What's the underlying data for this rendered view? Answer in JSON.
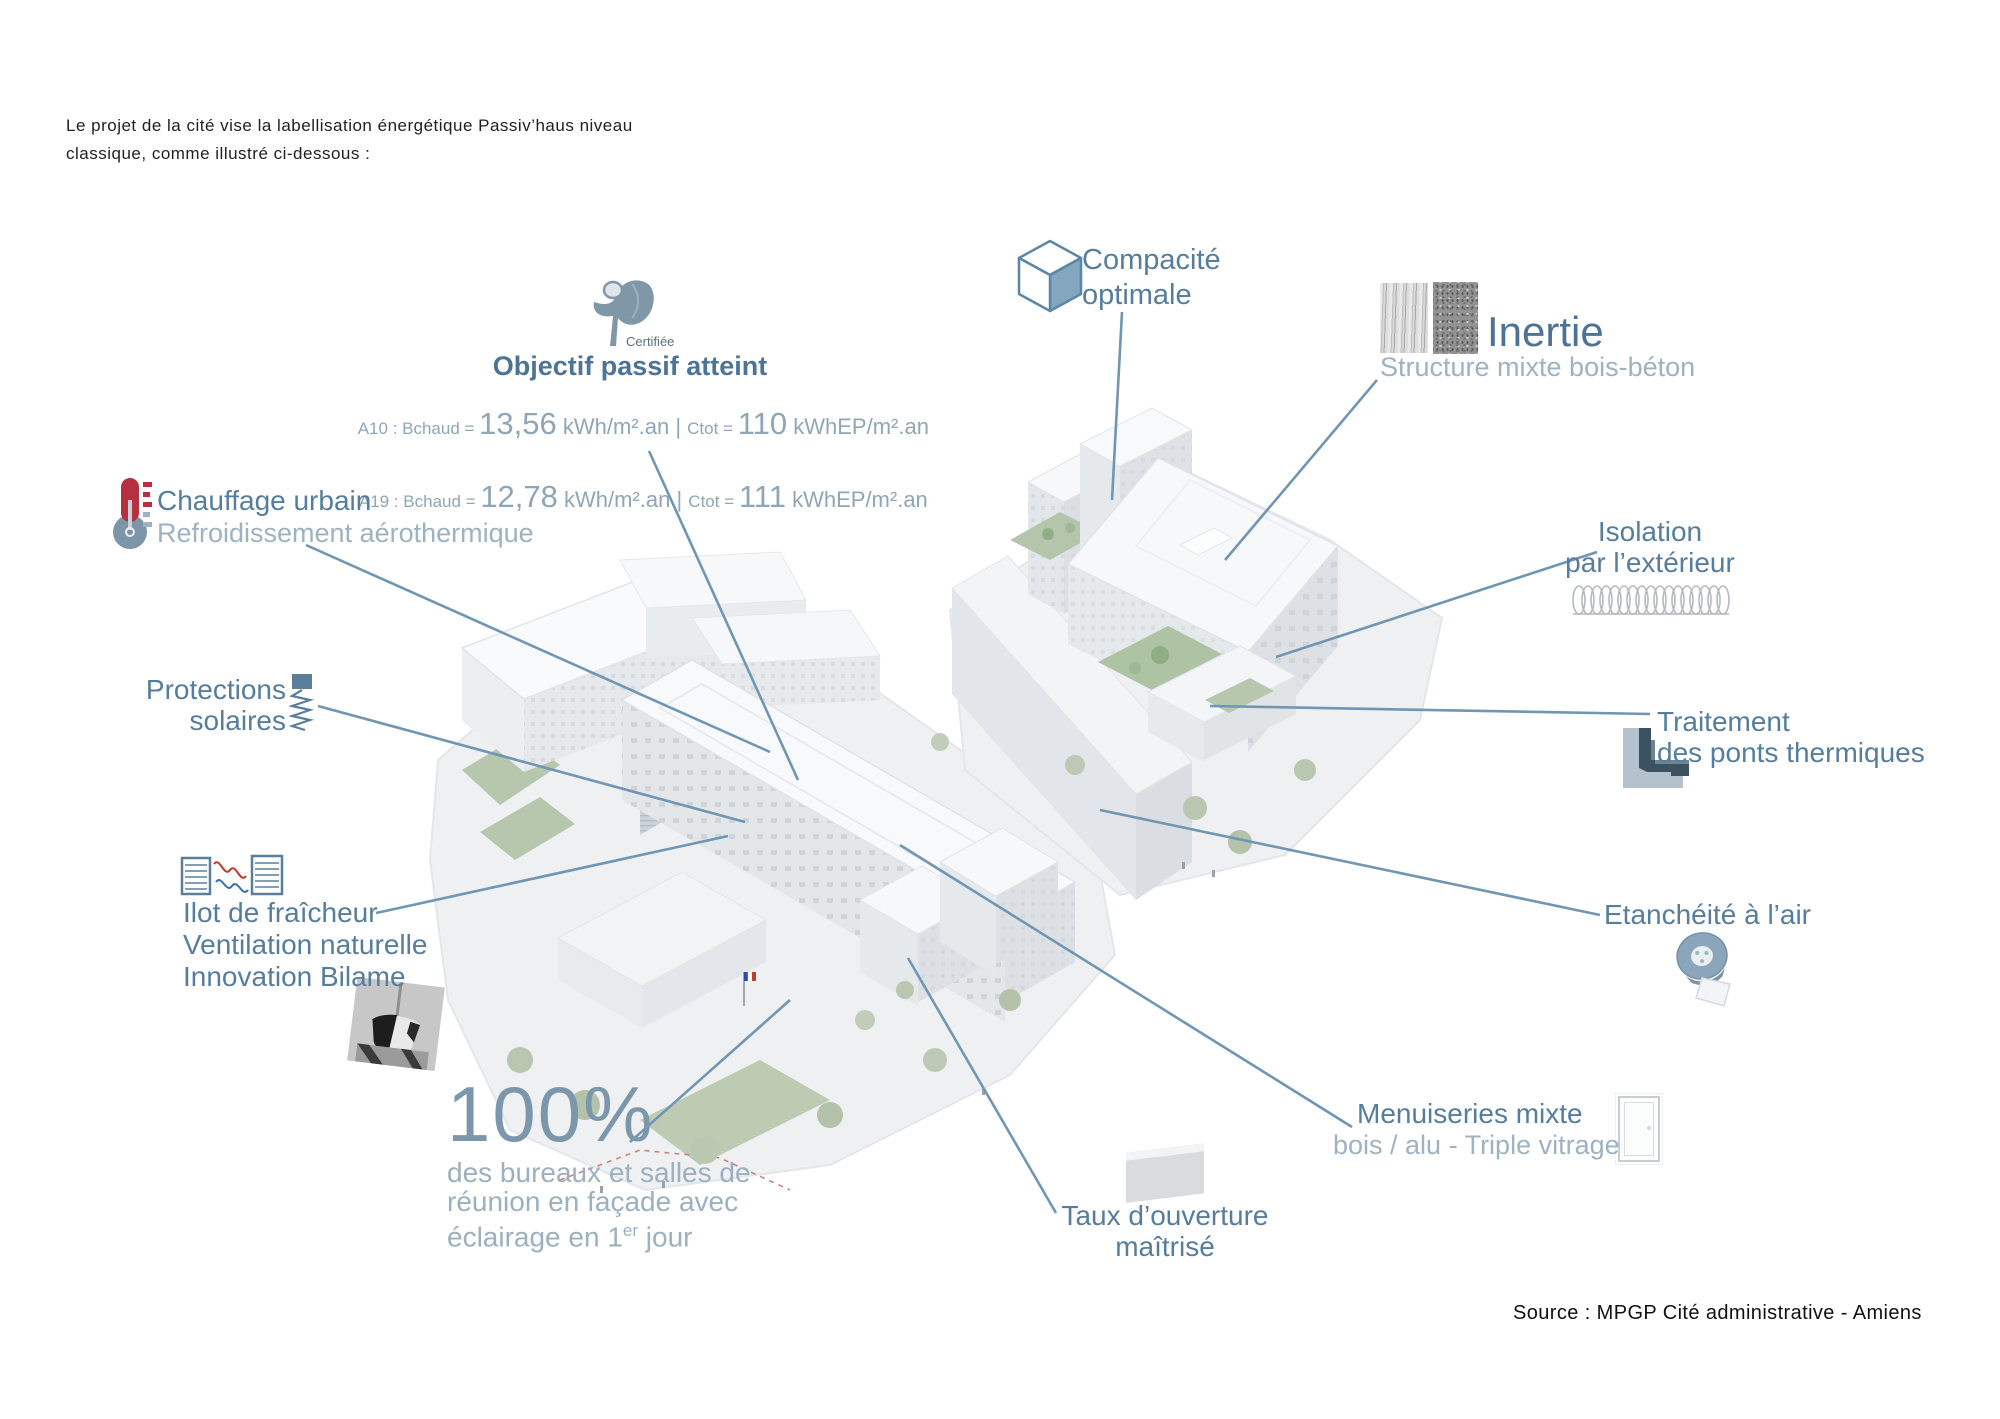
{
  "page": {
    "intro": "Le projet de la cité vise la labellisation énergétique Passiv’haus niveau classique, comme illustré ci-dessous :",
    "source": "Source : MPGP Cité administrative - Amiens"
  },
  "colors": {
    "leader_line": "#7096b3",
    "heading": "#567d9c",
    "subtle": "#9fb2c1",
    "thermometer_red": "#b6303e",
    "cube_face": "#82a7bf"
  },
  "callouts": {
    "objectif": {
      "certified_label": "Certifiée",
      "title": "Objectif passif atteint",
      "stats": [
        {
          "prefix": "A10 : Bchaud = ",
          "heating_value": "13,56",
          "heating_unit": " kWh/m².an ",
          "separator": "| ",
          "ctot_label": "Ctot = ",
          "ctot_value": "110",
          "ctot_unit": " kWhEP/m².an"
        },
        {
          "prefix": "A19 : Bchaud = ",
          "heating_value": "12,78",
          "heating_unit": " kWh/m².an ",
          "separator": "| ",
          "ctot_label": "Ctot = ",
          "ctot_value": "111",
          "ctot_unit": " kWhEP/m².an"
        }
      ]
    },
    "compacite": {
      "title": "Compacité\noptimale"
    },
    "inertie": {
      "title": "Inertie",
      "subtitle": "Structure mixte bois-béton"
    },
    "chauffage": {
      "title": "Chauffage urbain",
      "subtitle": "Refroidissement aérothermique"
    },
    "isolation": {
      "title": "Isolation\npar l’extérieur"
    },
    "protections": {
      "title": "Protections\nsolaires"
    },
    "traitement": {
      "title": "Traitement\ndes ponts thermiques"
    },
    "ilot": {
      "title": "Ilot de fraîcheur\nVentilation naturelle\nInnovation Bilame"
    },
    "etancheite": {
      "title": "Etanchéité à l’air"
    },
    "daylight": {
      "value": "100%",
      "line1": "des bureaux et salles de",
      "line2": "réunion en façade avec",
      "line3_before_sup": "éclairage en 1",
      "line3_sup": "er",
      "line3_after_sup": " jour"
    },
    "menuiseries": {
      "title": "Menuiseries mixte",
      "subtitle": "bois / alu - Triple vitrage"
    },
    "taux": {
      "title": "Taux d’ouverture\nmaîtrisé"
    }
  }
}
